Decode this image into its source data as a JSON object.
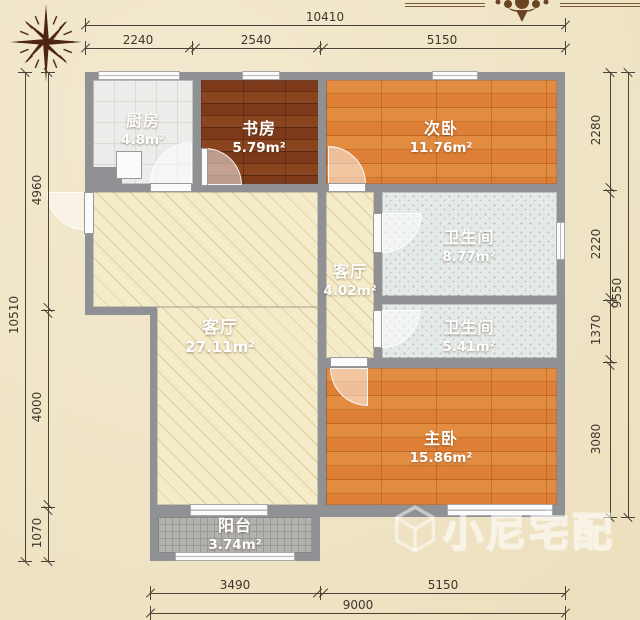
{
  "rooms": {
    "kitchen": {
      "name": "厨房",
      "area": "4.8m²"
    },
    "study": {
      "name": "书房",
      "area": "5.79m²"
    },
    "bedroom2": {
      "name": "次卧",
      "area": "11.76m²"
    },
    "bathroom1": {
      "name": "卫生间",
      "area": "8.77m²"
    },
    "hallway": {
      "name": "客厅",
      "area": "4.02m²"
    },
    "bathroom2": {
      "name": "卫生间",
      "area": "5.41m²"
    },
    "living": {
      "name": "客厅",
      "area": "27.11m²"
    },
    "master": {
      "name": "主卧",
      "area": "15.86m²"
    },
    "balcony": {
      "name": "阳台",
      "area": "3.74m²"
    }
  },
  "dimensions": {
    "top": {
      "total": "10410",
      "segments": [
        "2240",
        "2540",
        "5150"
      ]
    },
    "left": {
      "total": "10510",
      "segments": [
        "4960",
        "4000",
        "1070"
      ]
    },
    "right": {
      "total": "9550",
      "segments": [
        "2280",
        "2220",
        "1370",
        "3080"
      ]
    },
    "bottom": {
      "total": "9000",
      "segments": [
        "3490",
        "5150"
      ]
    }
  },
  "watermark": {
    "text": "小尼宅配"
  },
  "colors": {
    "background": "#efe4c6",
    "wall": "#8f9194",
    "wood_dark": "#7b3a1b",
    "wood_orange": "#df8740",
    "tile_light": "#ecedeb",
    "bath_tile": "#e4eae8",
    "living_floor": "#f4ebc9",
    "balcony_floor": "#b2b2ae",
    "dimension_text": "#3e372c",
    "compass": "#4f2512",
    "ornament": "#6b4423"
  }
}
